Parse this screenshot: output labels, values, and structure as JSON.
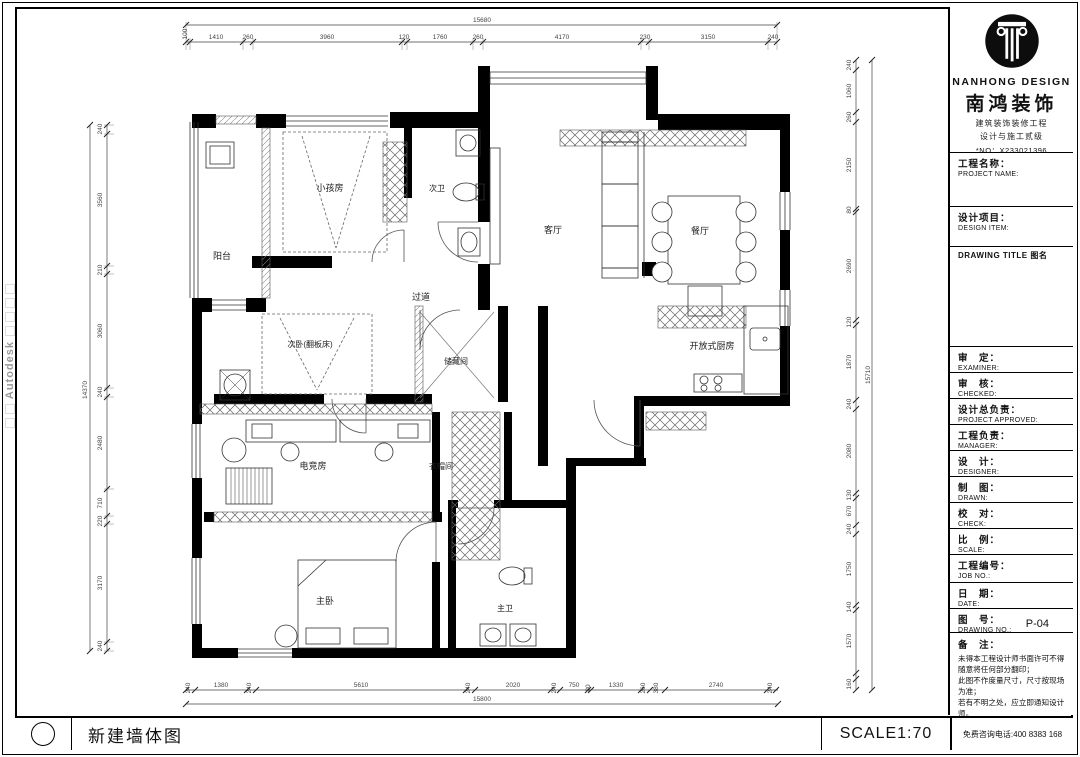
{
  "watermark": {
    "text": "Autodesk"
  },
  "plan": {
    "rooms": {
      "kids": "小孩房",
      "bath2": "次卫",
      "balcony": "阳台",
      "living": "客厅",
      "dining": "餐厅",
      "hall": "过道",
      "bed2": "次卧(翻板床)",
      "storage": "储藏间",
      "kitchen": "开放式厨房",
      "game": "电竞房",
      "cloak": "衣帽间",
      "master": "主卧",
      "bath1": "主卫"
    },
    "dims": {
      "top_total": "15680",
      "top": [
        "100",
        "1410",
        "260",
        "3960",
        "120",
        "1760",
        "260",
        "4170",
        "230",
        "3150",
        "240"
      ],
      "left_total": "14370",
      "left": [
        "240",
        "3560",
        "210",
        "3060",
        "240",
        "2480",
        "710",
        "220",
        "3170",
        "240"
      ],
      "right_total": "15710",
      "right": [
        "240",
        "1060",
        "260",
        "2150",
        "80",
        "2690",
        "120",
        "1870",
        "240",
        "2080",
        "130",
        "670",
        "240",
        "1750",
        "140",
        "1570",
        "160"
      ],
      "bottom_total": "15800",
      "bottom": [
        "240",
        "1380",
        "240",
        "5610",
        "240",
        "2020",
        "240",
        "750",
        "80",
        "1330",
        "260",
        "380",
        "2740",
        "240"
      ]
    }
  },
  "brand": {
    "en": "NANHONG DESIGN",
    "cn": "南鸿装饰",
    "cert1": "建筑装饰装修工程",
    "cert2": "设计与施工贰级",
    "no": "*NO：X233021396"
  },
  "fields": {
    "project": {
      "cn": "工程名称：",
      "en": "PROJECT NAME:"
    },
    "item": {
      "cn": "设计项目：",
      "en": "DESIGN ITEM:"
    },
    "drawing_title": "DRAWING TITLE 图名",
    "examiner": {
      "cn": "审　定：",
      "en": "EXAMINER:"
    },
    "checked": {
      "cn": "审　核：",
      "en": "CHECKED:"
    },
    "approved": {
      "cn": "设计总负责：",
      "en": "PROJECT APPROVED:"
    },
    "manager": {
      "cn": "工程负责：",
      "en": "MANAGER:"
    },
    "designer": {
      "cn": "设　计：",
      "en": "DESIGNER:"
    },
    "drawn": {
      "cn": "制　图：",
      "en": "DRAWN:"
    },
    "check": {
      "cn": "校　对：",
      "en": "CHECK:"
    },
    "scale": {
      "cn": "比　例：",
      "en": "SCALE:"
    },
    "job": {
      "cn": "工程编号：",
      "en": "JOB NO.:"
    },
    "date": {
      "cn": "日　期：",
      "en": "DATE:"
    },
    "dwg": {
      "cn": "图　号：",
      "en": "DRAWING NO.:",
      "value": "P-04"
    },
    "notes": {
      "cn": "备　注：",
      "lines": [
        "未得本工程设计师书面许可不得",
        "随意将任何部分翻印；",
        "此图不作度量尺寸，尺寸按现场",
        "为准；",
        "若有不明之处，应立即通知设计",
        "师。"
      ],
      "fine": "本设计解释权归设计师所有。"
    }
  },
  "footer": {
    "drawing_name": "新建墙体图",
    "scale": "SCALE1:70",
    "phone": "免费咨询电话:400 8383 168"
  }
}
